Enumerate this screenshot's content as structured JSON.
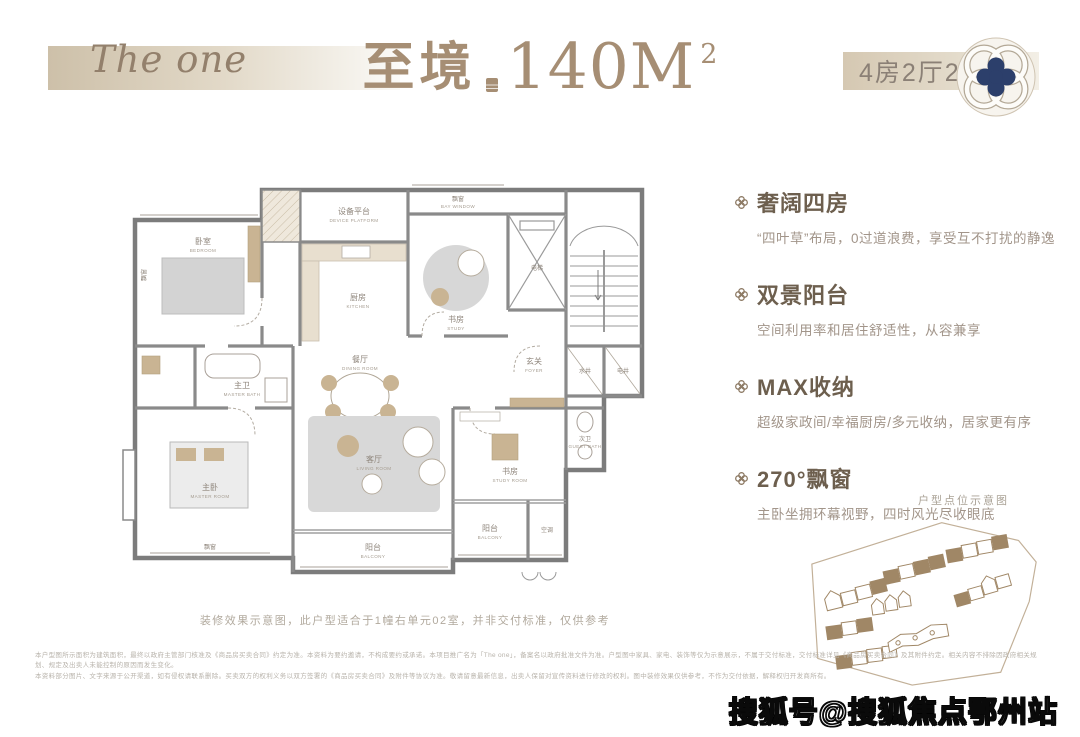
{
  "header": {
    "brand": "The one",
    "title_zh": "至境",
    "title_area": "140M",
    "title_sup": "2",
    "spec_badge": "4房2厅2卫"
  },
  "features": [
    {
      "title": "奢阔四房",
      "desc": "“四叶草”布局，0过道浪费，享受互不打扰的静逸"
    },
    {
      "title": "双景阳台",
      "desc": "空间利用率和居住舒适性，从容兼享"
    },
    {
      "title": "MAX收纳",
      "desc": "超级家政间/幸福厨房/多元收纳，居家更有序"
    },
    {
      "title": "270°飘窗",
      "desc": "主卧坐拥环幕视野，四时风光尽收眼底"
    }
  ],
  "floor_plan": {
    "rooms": [
      {
        "zh": "设备平台",
        "en": "DEVICE PLATFORM"
      },
      {
        "zh": "飘窗",
        "en": "BAY WINDOW"
      },
      {
        "zh": "卧室",
        "en": "BEDROOM"
      },
      {
        "zh": "书房",
        "en": "STUDY"
      },
      {
        "zh": "电梯",
        "en": "ELEV."
      },
      {
        "zh": "厨房",
        "en": "KITCHEN"
      },
      {
        "zh": "餐厅",
        "en": "DINING ROOM"
      },
      {
        "zh": "玄关",
        "en": "FOYER"
      },
      {
        "zh": "水井",
        "en": ""
      },
      {
        "zh": "电井",
        "en": ""
      },
      {
        "zh": "主卫",
        "en": "MASTER BATH"
      },
      {
        "zh": "主卧",
        "en": "MASTER ROOM"
      },
      {
        "zh": "客厅",
        "en": "LIVING ROOM"
      },
      {
        "zh": "书房",
        "en": "STUDY ROOM"
      },
      {
        "zh": "阳台",
        "en": "BALCONY"
      },
      {
        "zh": "空调",
        "en": "A/C"
      },
      {
        "zh": "次卫",
        "en": "GUEST BATH"
      }
    ]
  },
  "site_plan": {
    "label": "户型点位示意图"
  },
  "note": "装修效果示意图，此户型适合于1幢右单元02室，并非交付标准，仅供参考",
  "disclaimer": {
    "line1": "本户型图所示面积为建筑面积，最终以政府主管部门核准及《商品房买卖合同》约定为准。本资料为要约邀请，不构成要约或承诺。本项目推广名为「The one」，备案名以政府批准文件为准。户型图中家具、家电、装饰等仅为示意展示，不属于交付标准，交付标准详见《商品房买卖合同》及其附件约定。相关内容不排除因政府相关规划、规定及出卖人未能控制的原因而发生变化。",
    "line2": "本资料部分图片、文字来源于公开渠道，如有侵权请联系删除。买卖双方的权利义务以双方签署的《商品房买卖合同》及附件等协议为准。敬请留意最新信息，出卖人保留对宣传资料进行修改的权利。图中装修效果仅供参考，不作为交付依据，解释权归开发商所有。"
  },
  "watermark": "搜狐号@搜狐焦点鄂州站",
  "colors": {
    "accent_tan": "#a68e74",
    "band_beige": "#cdc0a9",
    "feature_title": "#6d5f4e",
    "feature_desc": "#a2958a",
    "plan_wall": "#7c7c7c",
    "furniture_beige": "#c9b493",
    "furniture_gray": "#d6d6d6",
    "site_tan": "#a08766",
    "emblem_navy": "#2c3f6b"
  }
}
